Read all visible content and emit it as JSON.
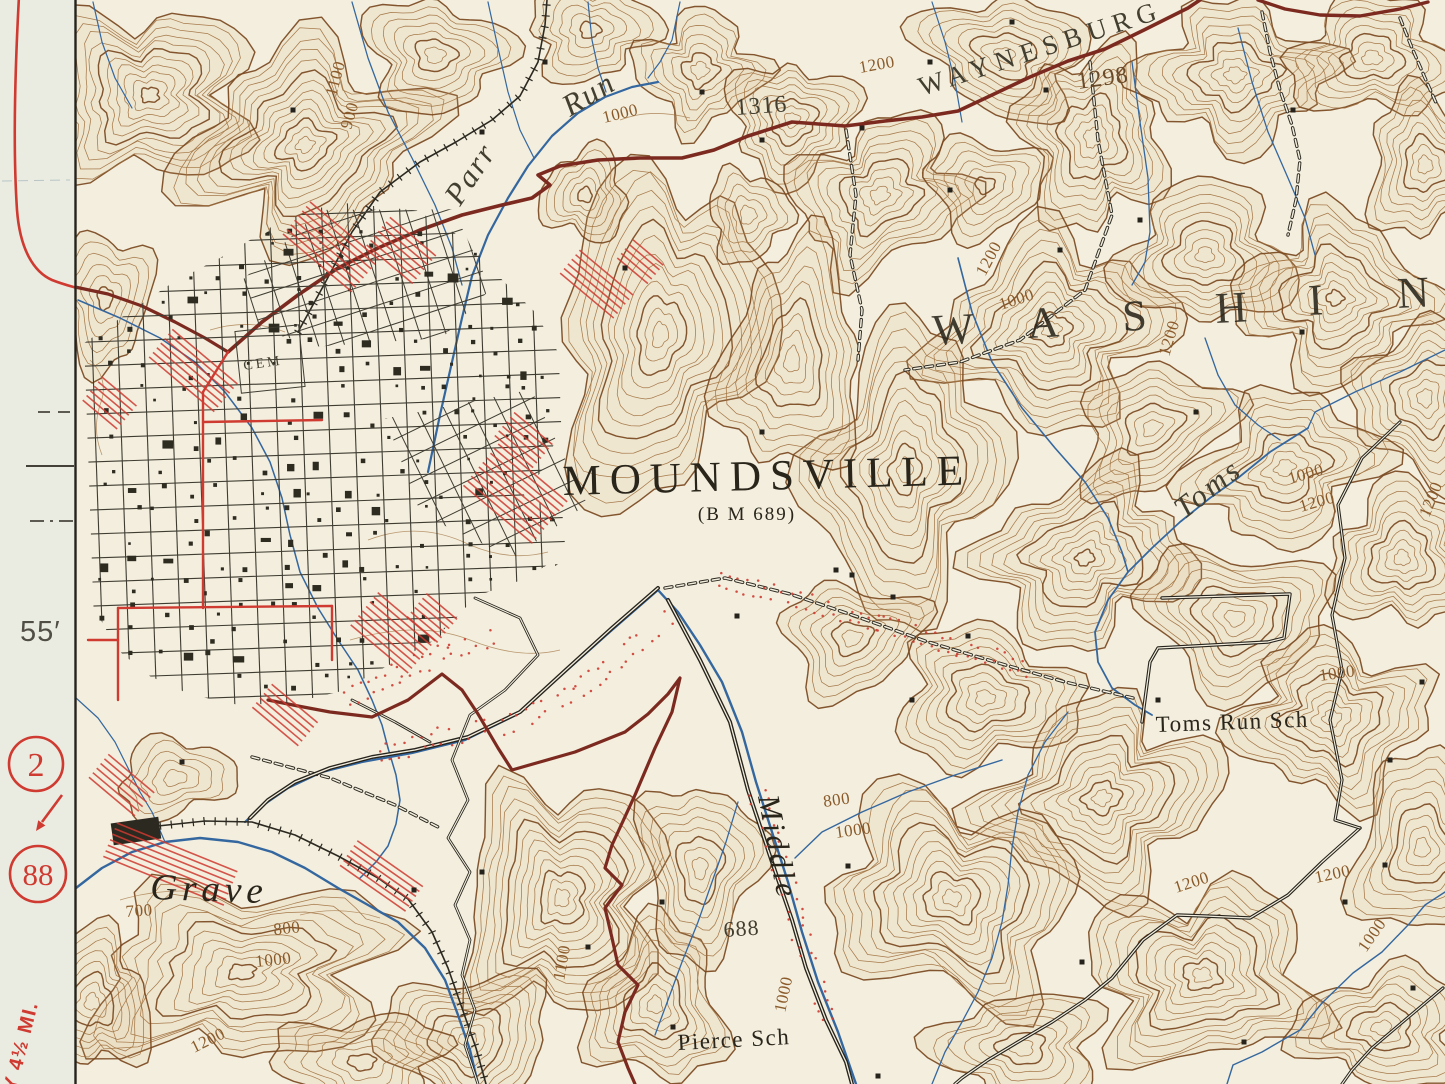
{
  "colors": {
    "paper": "#f3eedd",
    "margin_paper": "#eaece2",
    "contour": "#a0713f",
    "contour_index": "#7a4920",
    "water": "#34679f",
    "road_maroon": "#7c2a20",
    "highway_red": "#cf3a31",
    "ink": "#29251b",
    "ink2": "#423e30",
    "brown": "#8a5a2a",
    "brown2": "#6b4a2a"
  },
  "margin": {
    "minute_label": "55′",
    "badge_top": "2",
    "badge_bottom": "88",
    "rotated_note": "Y 4½ MI."
  },
  "labels": [
    {
      "name": "town-name",
      "text": "MOUNDSVILLE"
    },
    {
      "name": "benchmark",
      "text": "(B M 689)"
    },
    {
      "name": "region-name",
      "text": "WASHIN"
    },
    {
      "name": "road-name-waynesburg",
      "text": "WAYNESBURG"
    },
    {
      "name": "stream-parr",
      "text": "Parr"
    },
    {
      "name": "stream-run",
      "text": "Run"
    },
    {
      "name": "stream-grave",
      "text": "Grave"
    },
    {
      "name": "stream-middle",
      "text": "Middle"
    },
    {
      "name": "stream-toms",
      "text": "Toms"
    },
    {
      "name": "school-toms-run",
      "text": "Toms Run Sch"
    },
    {
      "name": "school-pierce",
      "text": "Pierce Sch"
    },
    {
      "name": "cemetery",
      "text": "CEM"
    },
    {
      "name": "spot-1316",
      "text": "1316"
    },
    {
      "name": "spot-1298",
      "text": "1298"
    },
    {
      "name": "spot-688",
      "text": "688"
    },
    {
      "name": "contour-a",
      "text": "1100"
    },
    {
      "name": "contour-b",
      "text": "900"
    },
    {
      "name": "contour-c",
      "text": "1000"
    },
    {
      "name": "contour-d",
      "text": "1200"
    },
    {
      "name": "contour-e",
      "text": "1200"
    },
    {
      "name": "contour-f",
      "text": "1000"
    },
    {
      "name": "contour-g",
      "text": "1200"
    },
    {
      "name": "contour-h",
      "text": "1000"
    },
    {
      "name": "contour-i",
      "text": "1200"
    },
    {
      "name": "contour-j",
      "text": "1200"
    },
    {
      "name": "contour-k",
      "text": "1000"
    },
    {
      "name": "contour-l",
      "text": "700"
    },
    {
      "name": "contour-m",
      "text": "800"
    },
    {
      "name": "contour-n",
      "text": "1000"
    },
    {
      "name": "contour-o",
      "text": "1200"
    },
    {
      "name": "contour-p",
      "text": "1100"
    },
    {
      "name": "contour-q",
      "text": "800"
    },
    {
      "name": "contour-r",
      "text": "1000"
    },
    {
      "name": "contour-s",
      "text": "1200"
    },
    {
      "name": "contour-t",
      "text": "1200"
    },
    {
      "name": "contour-u",
      "text": "1000"
    },
    {
      "name": "contour-v",
      "text": "1000"
    }
  ]
}
